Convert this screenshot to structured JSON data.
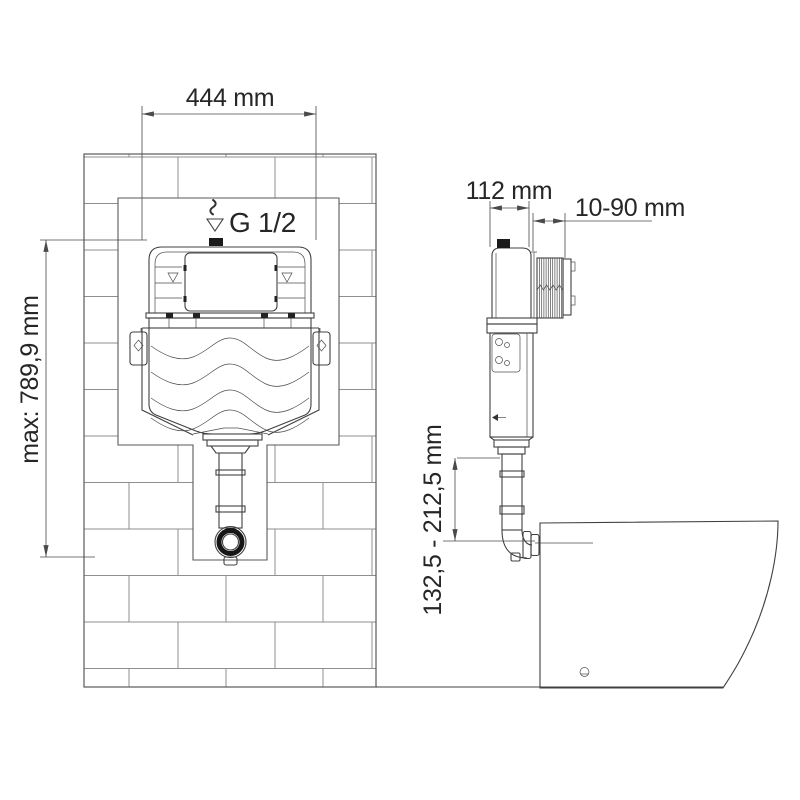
{
  "labels": {
    "frame_width": "444 mm",
    "max_height": "max: 789,9 mm",
    "water_inlet": "G 1/2",
    "cistern_depth": "112 mm",
    "wall_depth_range": "10-90 mm",
    "flush_pipe_range": "132,5 - 212,5 mm"
  },
  "colors": {
    "line": "#404040",
    "brick": "#8f8f8f",
    "text": "#262626",
    "dark_fill": "#1b1b1b",
    "background": "#ffffff"
  }
}
